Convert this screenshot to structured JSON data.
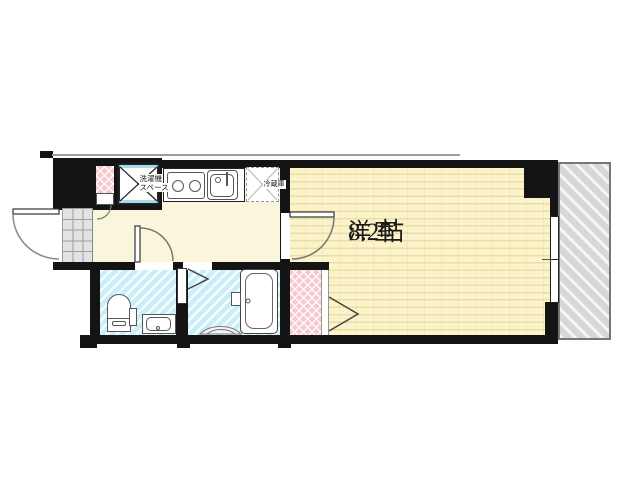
{
  "floor_plan": {
    "main_room": {
      "name": "洋室",
      "size": "8.2帖"
    },
    "washer_space": {
      "line1": "洗濯機",
      "line2": "スペース"
    },
    "refrigerator": {
      "label": "冷蔵庫"
    },
    "colors": {
      "wall": "#141414",
      "hallway_floor": "#FAF6DB",
      "main_room_floor": "#FBF3CB",
      "main_room_stripe": "#EDDFA3",
      "wet_room_floor": "#C9EEF8",
      "closet_pink": "#F7C9CF",
      "balcony_gray": "#D7D7D7",
      "genkan_gray": "#E3E3E3",
      "washer_accent": "#A6D9E9"
    }
  }
}
